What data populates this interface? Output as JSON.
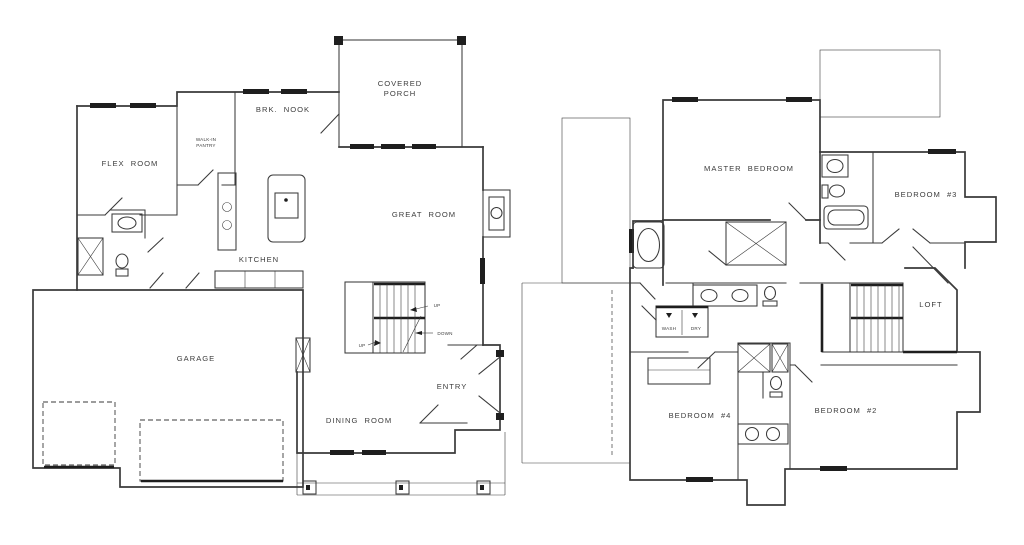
{
  "colors": {
    "bg": "#ffffff",
    "wall": "#3a3a3a",
    "dark": "#1e1e1e",
    "text": "#3c3c3c"
  },
  "floor1": {
    "flex_room": "FLEX ROOM",
    "walk_in_pantry_line1": "WALK-IN",
    "walk_in_pantry_line2": "PANTRY",
    "brk_nook": "BRK. NOOK",
    "covered_porch_line1": "COVERED",
    "covered_porch_line2": "PORCH",
    "kitchen": "KITCHEN",
    "great_room": "GREAT ROOM",
    "garage": "GARAGE",
    "dining_room": "DINING ROOM",
    "entry": "ENTRY",
    "stairs_up": "UP",
    "stairs_down": "DOWN",
    "stairs_up_lower": "UP"
  },
  "floor2": {
    "master_bedroom": "MASTER BEDROOM",
    "bedroom_3": "BEDROOM #3",
    "loft": "LOFT",
    "bedroom_4": "BEDROOM #4",
    "bedroom_2": "BEDROOM #2",
    "laundry_wash": "WASH",
    "laundry_dry": "DRY"
  }
}
